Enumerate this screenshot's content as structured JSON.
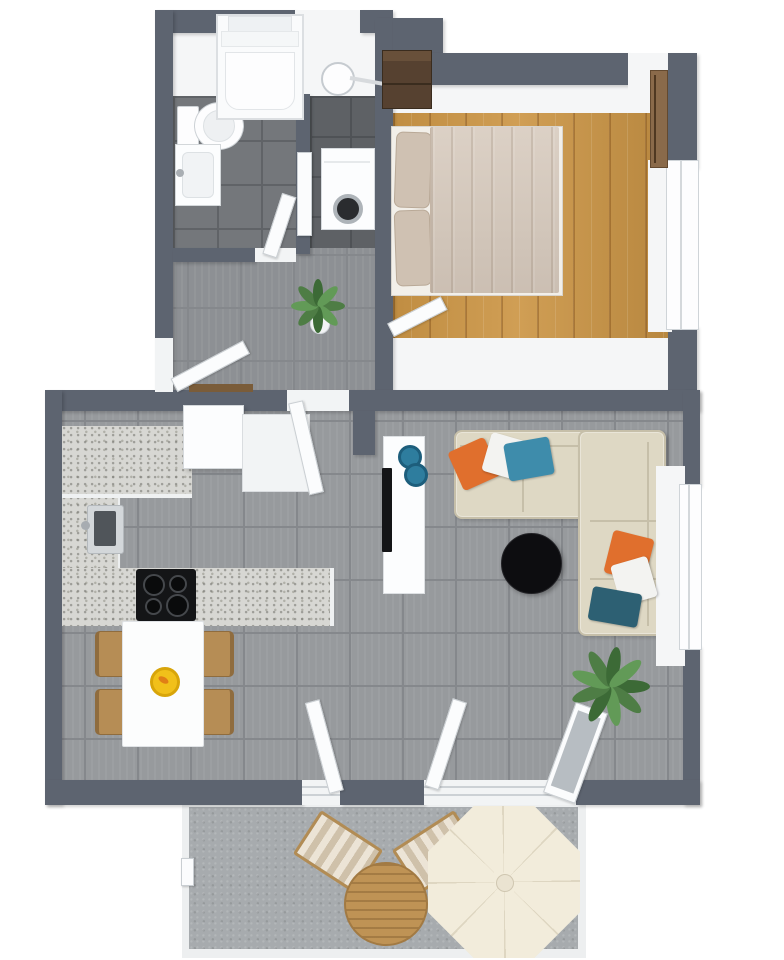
{
  "scene": {
    "title": "Apartment 3D Floor Plan Top-Down Render",
    "view": "top-down-3d-render",
    "background": "#ffffff",
    "visible_text": []
  },
  "palette": {
    "wall": "#5d6470",
    "interior-white": "#f5f6f7",
    "floor-tile": "#979a9d",
    "floor-grout": "#85888c",
    "hall-tile": "#8d9094",
    "bath-tile": "#74777b",
    "bath-grout": "#606367",
    "laundry-tile": "#5e6165",
    "laundry-grout": "#4f5256",
    "wood": "#cc9646",
    "concrete": "#a7abae",
    "counter": "#d7d7d3",
    "cabinet-white": "#fcfdfe",
    "sofa": "#ded8c4",
    "sofa-seam": "#c6bfa9",
    "pillow-orange": "#e06f2d",
    "pillow-white": "#f3f3f1",
    "pillow-teal": "#3e8cab",
    "pillow-dark-teal": "#2d6073",
    "coffee-table": "#0d0d10",
    "chair-tan": "#b68d55",
    "chair-edge": "#8f6c3e",
    "table-white": "#fcfdfd",
    "fruit-yellow": "#f1c01a",
    "plant": "#4e7d45",
    "plant-light": "#629a57",
    "plant-dark": "#3c6a36",
    "wardrobe": "#564130",
    "wall-art": "#8a6a4a",
    "bed-blanket": "#d6c9bc",
    "bed-pillow": "#cfc1b2",
    "washer-drum": "#2a2c2f",
    "glass": "#b7bdc2",
    "patio-table": "#bf9355",
    "umbrella": "#f2ecdb",
    "umbrella-seam": "#ded6c1",
    "lounger-a": "#ece4d6",
    "lounger-b": "#cfc1aa",
    "lounger-frame": "#b28c54",
    "doormat": "#7a5c39",
    "tv-black": "#141517",
    "bowl-teal": "#2e7d9e",
    "sink-basin": "#50555a"
  },
  "rooms": [
    {
      "id": "bathroom",
      "floor": "dark-gray-tile",
      "furniture": [
        "walk-in-shower",
        "toilet",
        "sink-vanity",
        "wall-mirror-lamp"
      ]
    },
    {
      "id": "laundry-closet",
      "floor": "dark-gray-tile",
      "furniture": [
        "washing-machine",
        "closet-door"
      ]
    },
    {
      "id": "bedroom",
      "floor": "oak-wood-planks",
      "furniture": [
        "double-bed",
        "two-pillows",
        "wardrobe",
        "wall-art",
        "window",
        "bedroom-door"
      ]
    },
    {
      "id": "hallway",
      "floor": "gray-tile",
      "furniture": [
        "potted-plant",
        "entry-door",
        "doormat",
        "bathroom-door",
        "interior-door"
      ]
    },
    {
      "id": "kitchen-dining",
      "floor": "gray-tile",
      "furniture": [
        "l-shaped-counter",
        "kitchen-sink",
        "cooktop-4-burners",
        "refrigerator",
        "base-cabinet",
        "dining-table",
        "dining-chair-x4",
        "fruit-bowl"
      ]
    },
    {
      "id": "living-room",
      "floor": "gray-tile",
      "furniture": [
        "corner-sofa",
        "throw-pillows-orange-white-teal-x6",
        "round-coffee-table",
        "tv-sideboard",
        "tv",
        "decor-bowls-x2",
        "potted-plant",
        "window"
      ]
    },
    {
      "id": "patio",
      "floor": "concrete",
      "furniture": [
        "parasol-umbrella",
        "round-wood-table",
        "sun-lounger-x2",
        "patio-doors-x3",
        "side-gate-handle"
      ]
    }
  ]
}
